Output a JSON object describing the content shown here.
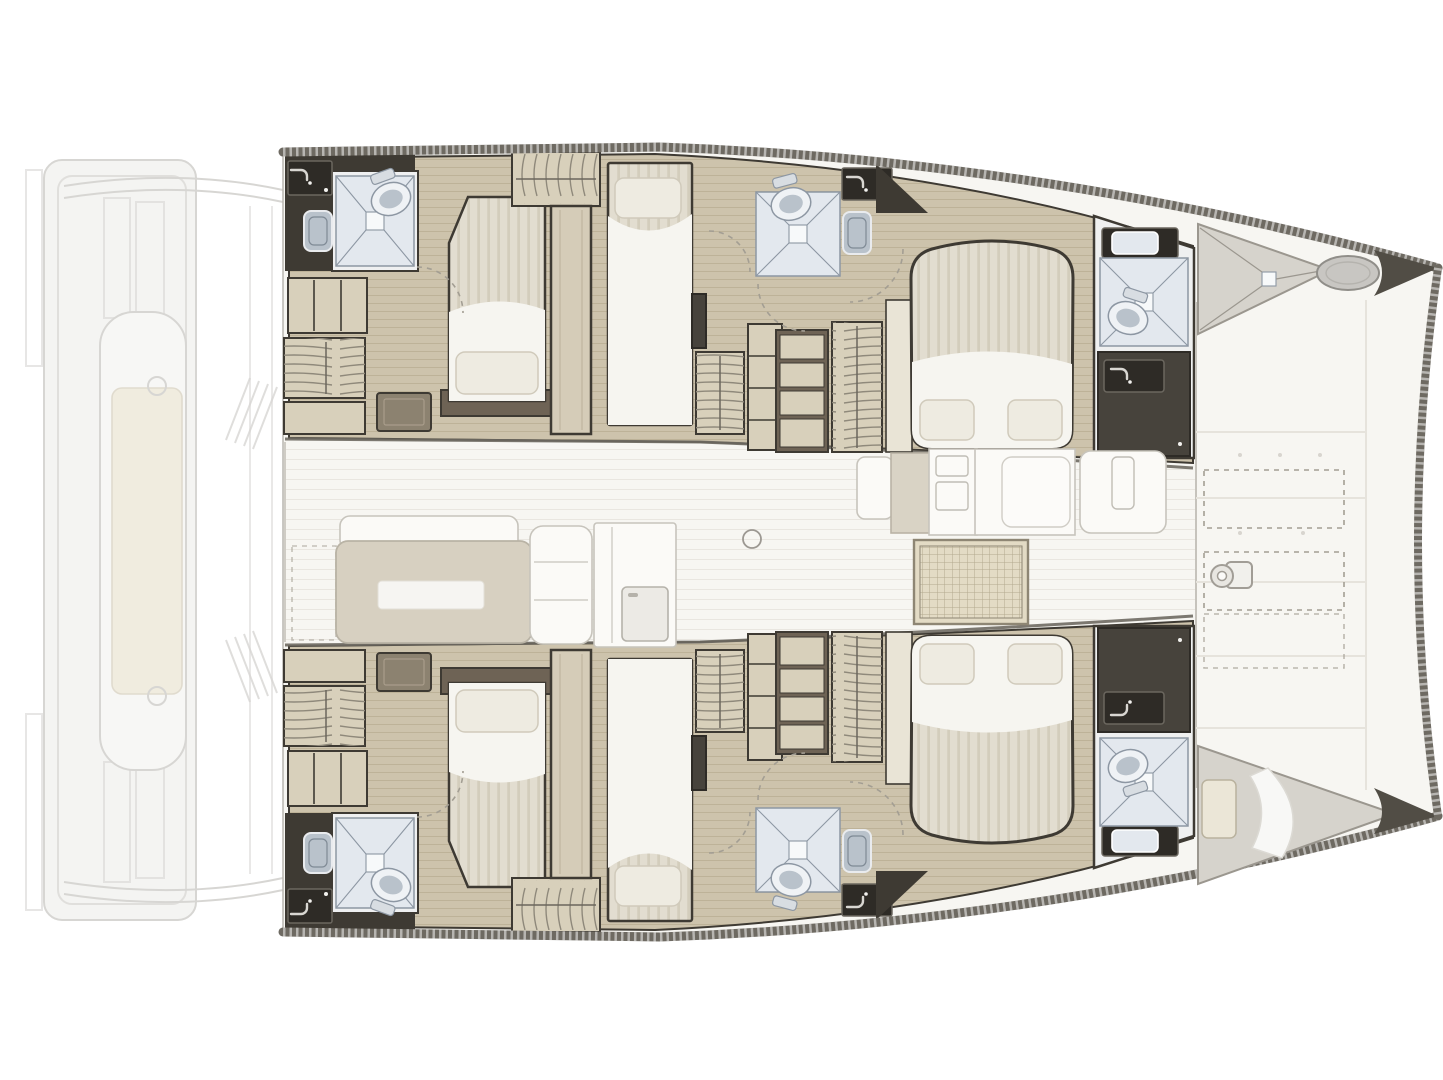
{
  "diagram": {
    "type": "floorplan",
    "subject": "catamaran-yacht-interior-deck-plan",
    "canvas": {
      "width": 1443,
      "height": 1080
    },
    "areas": [
      {
        "id": "aft-deck-ghost",
        "label": "Aft cockpit and platform (faded)"
      },
      {
        "id": "salon",
        "label": "Salon with sofa and galley"
      },
      {
        "id": "foredeck",
        "label": "Foredeck with deck lockers and windlass"
      },
      {
        "id": "port-aft-cabin",
        "label": "Port aft double cabin"
      },
      {
        "id": "port-aft-bathroom",
        "label": "Port aft bathroom with shower"
      },
      {
        "id": "port-mid-cabin",
        "label": "Port single berth cabin"
      },
      {
        "id": "port-mid-bathroom",
        "label": "Port mid bathroom with shower"
      },
      {
        "id": "port-forward-cabin",
        "label": "Port forward island-bed cabin"
      },
      {
        "id": "port-forward-bathroom",
        "label": "Port forward bathroom"
      },
      {
        "id": "port-forepeak",
        "label": "Port forepeak locker and deck hatch"
      },
      {
        "id": "starboard-hull",
        "label": "Starboard hull (mirror of port hull)"
      },
      {
        "id": "starboard-forepeak",
        "label": "Starboard forepeak crew berth"
      }
    ],
    "colors": {
      "bg": "#ffffff",
      "deck_white": "#f7f6f2",
      "deck_line": "#e6e3dc",
      "ghost_line": "#d7d6d3",
      "ghost_fill": "#f4f4f2",
      "hull_edge": "#6e6a62",
      "wall_dark": "#3e3a33",
      "charcoal": "#47433c",
      "charcoal_deep": "#2e2b26",
      "wood_floor": "#cdc3ac",
      "wood_line": "#b8ac91",
      "cabinet_light": "#d8d0bb",
      "cabinet_brown": "#8c8270",
      "brown_deep": "#6e6355",
      "mattress": "#e2ddd0",
      "mattress_stripe": "#d2cbba",
      "sheet": "#f6f5f0",
      "pillow": "#eeebe1",
      "pillow_edge": "#d0cabb",
      "fixture_blue": "#e3e8ee",
      "fixture_line": "#8d97a3",
      "toilet_fill": "#eff2f5",
      "sink_fill": "#b9c2cb",
      "sofa": "#d7d0c1",
      "sofa_line": "#b9b3a5",
      "white_furniture": "#fbfaf7",
      "furniture_line": "#c7c4bc",
      "grid_mat": "#e3dbc5",
      "grid_line": "#b3a98e",
      "hatch_gray": "#c8c6c2",
      "forepeak_gray": "#d6d3cc",
      "dash_color": "#a39e93"
    }
  }
}
